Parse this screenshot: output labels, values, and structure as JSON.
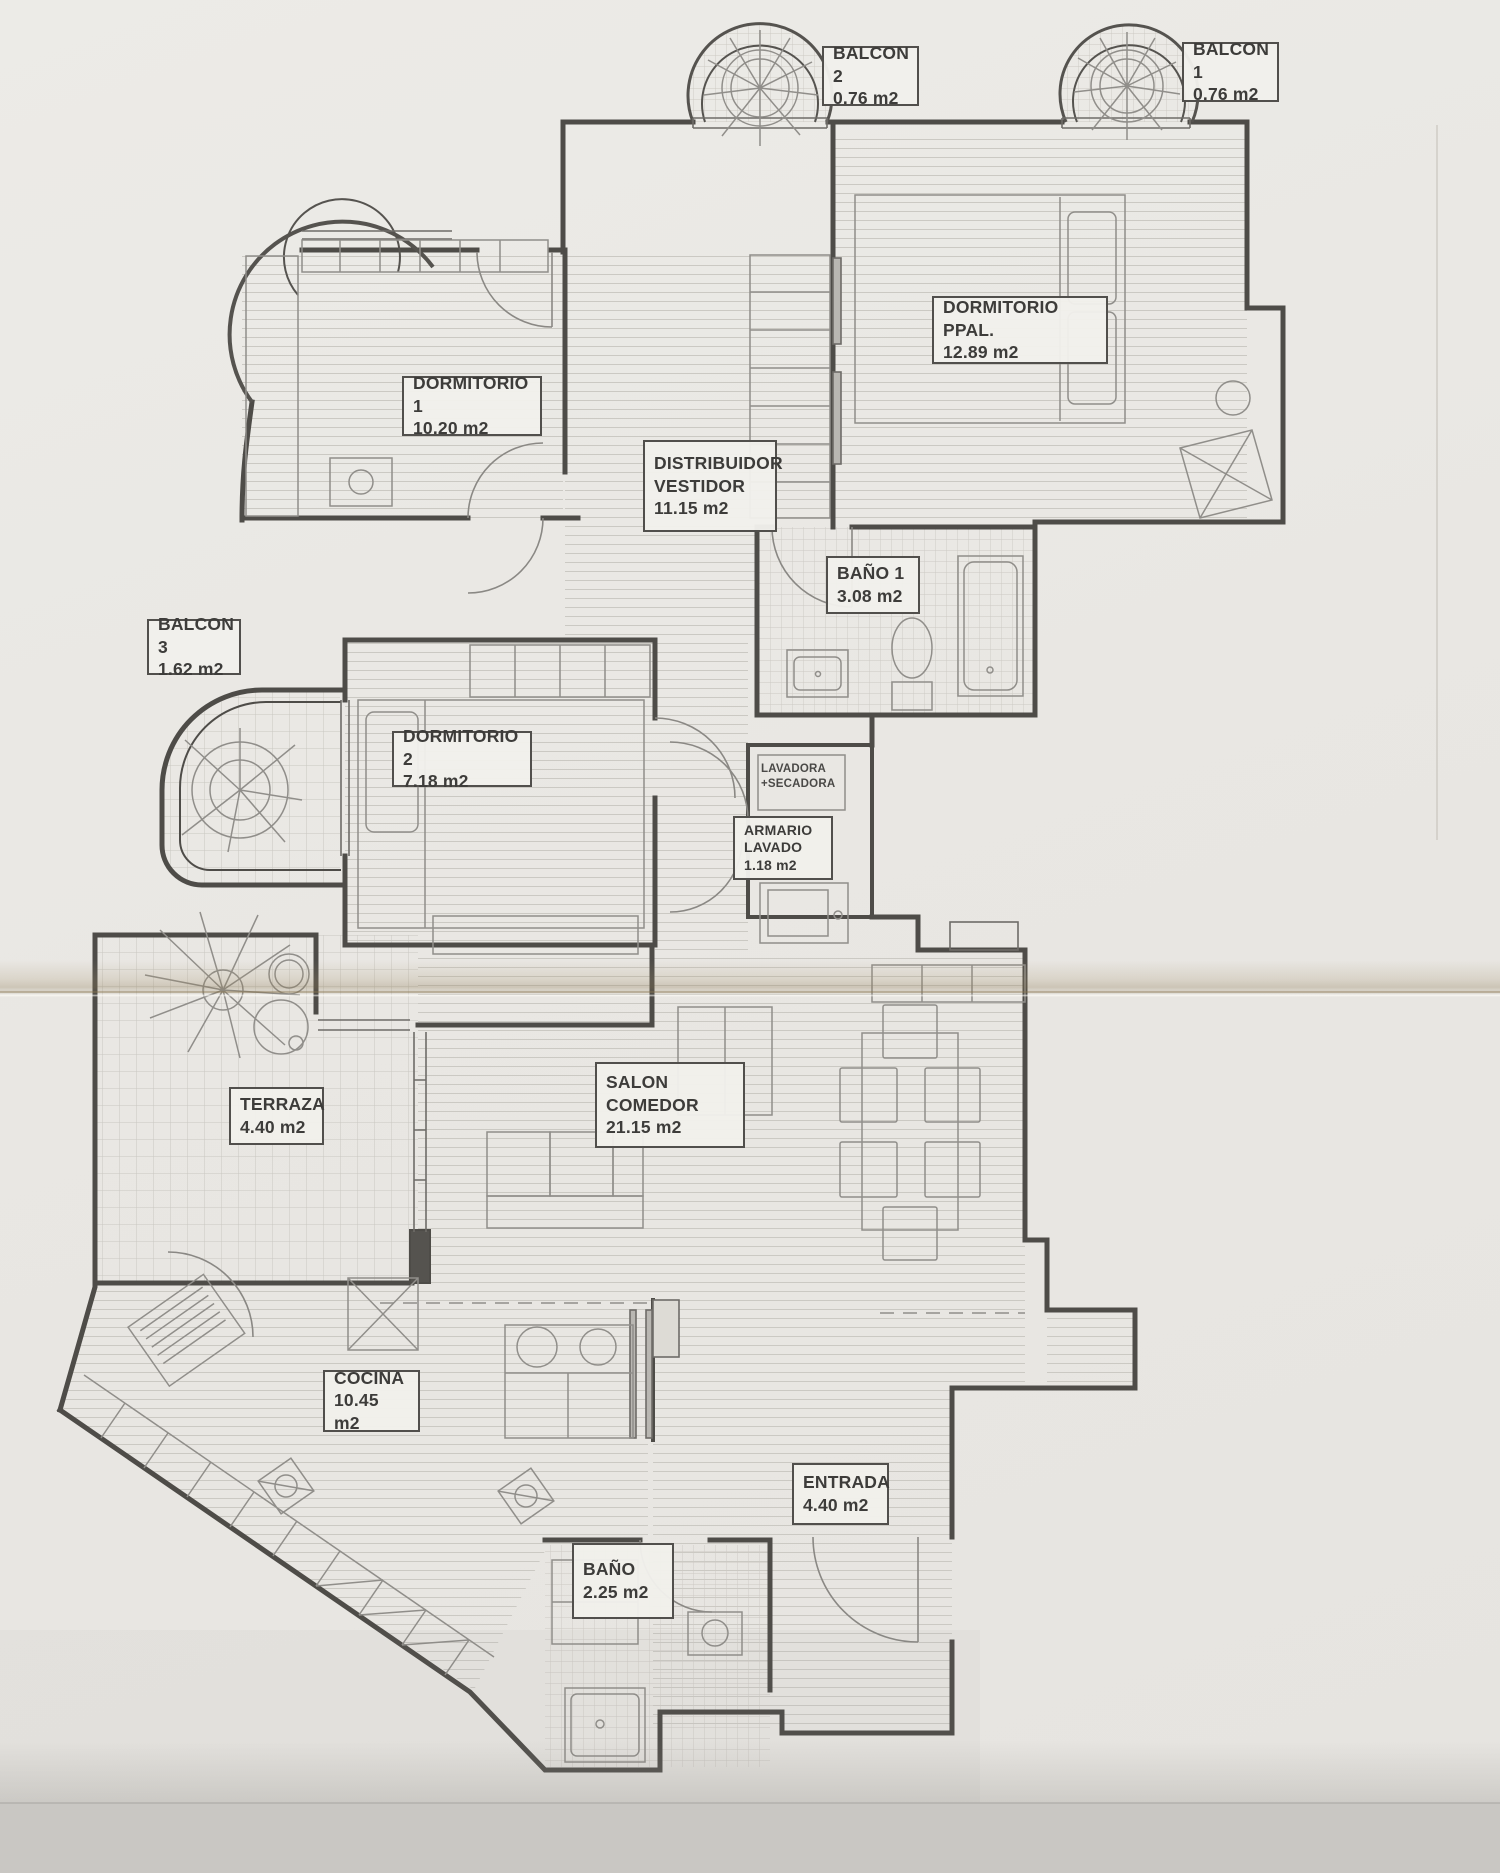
{
  "document": {
    "kind": "apartment floor plan (scanned drawing)",
    "units_suffix": "m2"
  },
  "rooms": [
    {
      "name": "BALCON 2",
      "area": "0.76 m2"
    },
    {
      "name": "BALCON 1",
      "area": "0.76 m2"
    },
    {
      "name": "DORMITORIO PPAL.",
      "area": "12.89 m2"
    },
    {
      "name": "DORMITORIO 1",
      "area": "10.20 m2"
    },
    {
      "name": "DISTRIBUIDOR\nVESTIDOR",
      "area": "11.15 m2"
    },
    {
      "name": "BAÑO 1",
      "area": "3.08 m2"
    },
    {
      "name": "BALCON 3",
      "area": "1.62 m2"
    },
    {
      "name": "DORMITORIO 2",
      "area": "7.18 m2"
    },
    {
      "name": "ARMARIO\nLAVADO",
      "area": "1.18 m2"
    },
    {
      "name": "TERRAZA",
      "area": "4.40 m2"
    },
    {
      "name": "SALON\nCOMEDOR",
      "area": "21.15 m2"
    },
    {
      "name": "COCINA",
      "area": "10.45 m2"
    },
    {
      "name": "ENTRADA",
      "area": "4.40 m2"
    },
    {
      "name": "BAÑO",
      "area": "2.25 m2"
    }
  ],
  "annotations": [
    {
      "text": "LAVADORA\n+SECADORA"
    }
  ],
  "colors": {
    "paper": "#eae8e4",
    "wall_line": "#4e4c48",
    "furniture_line": "#8e8c88",
    "hatch_line": "#cbc9c3",
    "crease": "#a08c66",
    "bottom_shadow": "#d5d3cf"
  }
}
